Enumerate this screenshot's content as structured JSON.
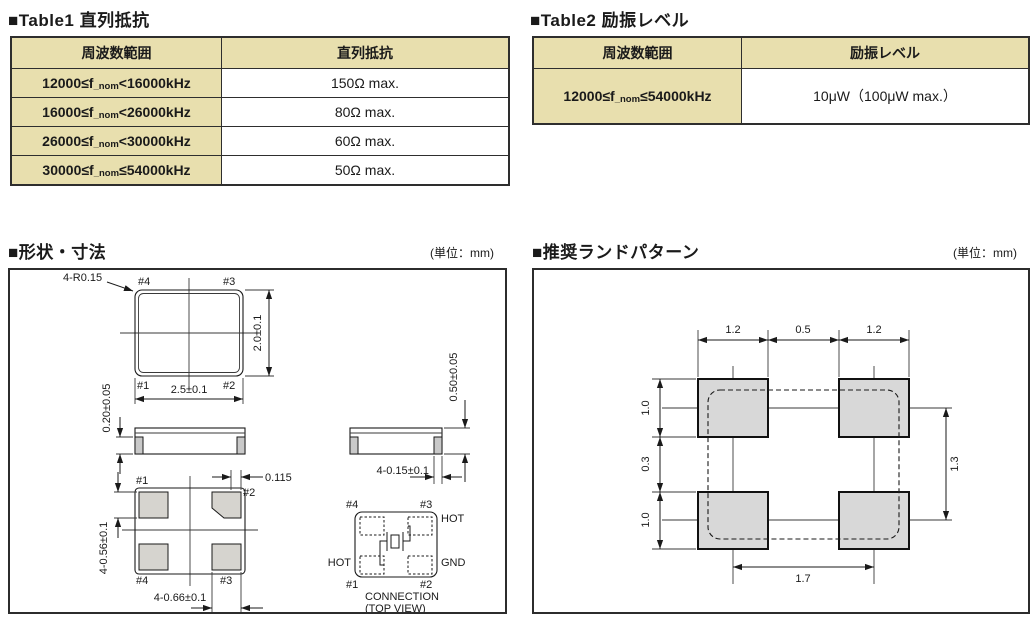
{
  "table1": {
    "title": "■Table1 直列抵抗",
    "headers": [
      "周波数範囲",
      "直列抵抗"
    ],
    "rows": [
      {
        "range_pre": "12000≤f",
        "range_sub": "_nom",
        "range_post": "<16000kHz",
        "value": "150Ω max."
      },
      {
        "range_pre": "16000≤f",
        "range_sub": "_nom",
        "range_post": "<26000kHz",
        "value": "80Ω max."
      },
      {
        "range_pre": "26000≤f",
        "range_sub": "_nom",
        "range_post": "<30000kHz",
        "value": "60Ω max."
      },
      {
        "range_pre": "30000≤f",
        "range_sub": "_nom",
        "range_post": "≤54000kHz",
        "value": "50Ω max."
      }
    ]
  },
  "table2": {
    "title": "■Table2 励振レベル",
    "headers": [
      "周波数範囲",
      "励振レベル"
    ],
    "rows": [
      {
        "range_pre": "12000≤f",
        "range_sub": "_nom",
        "range_post": "≤54000kHz",
        "value": "10μW（100μW max.）"
      }
    ]
  },
  "dimensions_section": {
    "title": "■形状・寸法",
    "unit": "(単位：mm)",
    "top_view": {
      "corner": "4-R0.15",
      "pin1": "#1",
      "pin2": "#2",
      "pin3": "#3",
      "pin4": "#4",
      "width": "2.5±0.1",
      "height": "2.0±0.1"
    },
    "side_view_left": {
      "thickness": "0.20±0.05"
    },
    "bottom_view": {
      "pin1": "#1",
      "pin2": "#2",
      "pin3": "#3",
      "pin4": "#4",
      "offset": "0.115",
      "pad_height": "4-0.56±0.1",
      "pad_width": "4-0.66±0.1"
    },
    "side_view_right": {
      "height": "0.50±0.05",
      "cap": "4-0.15±0.1"
    },
    "connection": {
      "pin1": "#1",
      "pin2": "#2",
      "pin3": "#3",
      "pin4": "#4",
      "hot_top": "HOT",
      "hot_left": "HOT",
      "gnd": "GND",
      "caption_line1": "CONNECTION",
      "caption_line2": "(TOP VIEW)"
    }
  },
  "land_pattern_section": {
    "title": "■推奨ランドパターン",
    "unit": "(単位：mm)",
    "dims": {
      "top_left_pad": "1.2",
      "top_gap": "0.5",
      "top_right_pad": "1.2",
      "left_top": "1.0",
      "left_gap": "0.3",
      "left_bottom": "1.0",
      "right_span": "1.3",
      "bottom_span": "1.7"
    }
  },
  "colors": {
    "table_header_bg": "#e8dfae",
    "table_border": "#2e2e2e",
    "land_pad_fill": "#d8d8d8",
    "pad_fill": "#d6d4cf",
    "line": "#1a1a1a"
  }
}
